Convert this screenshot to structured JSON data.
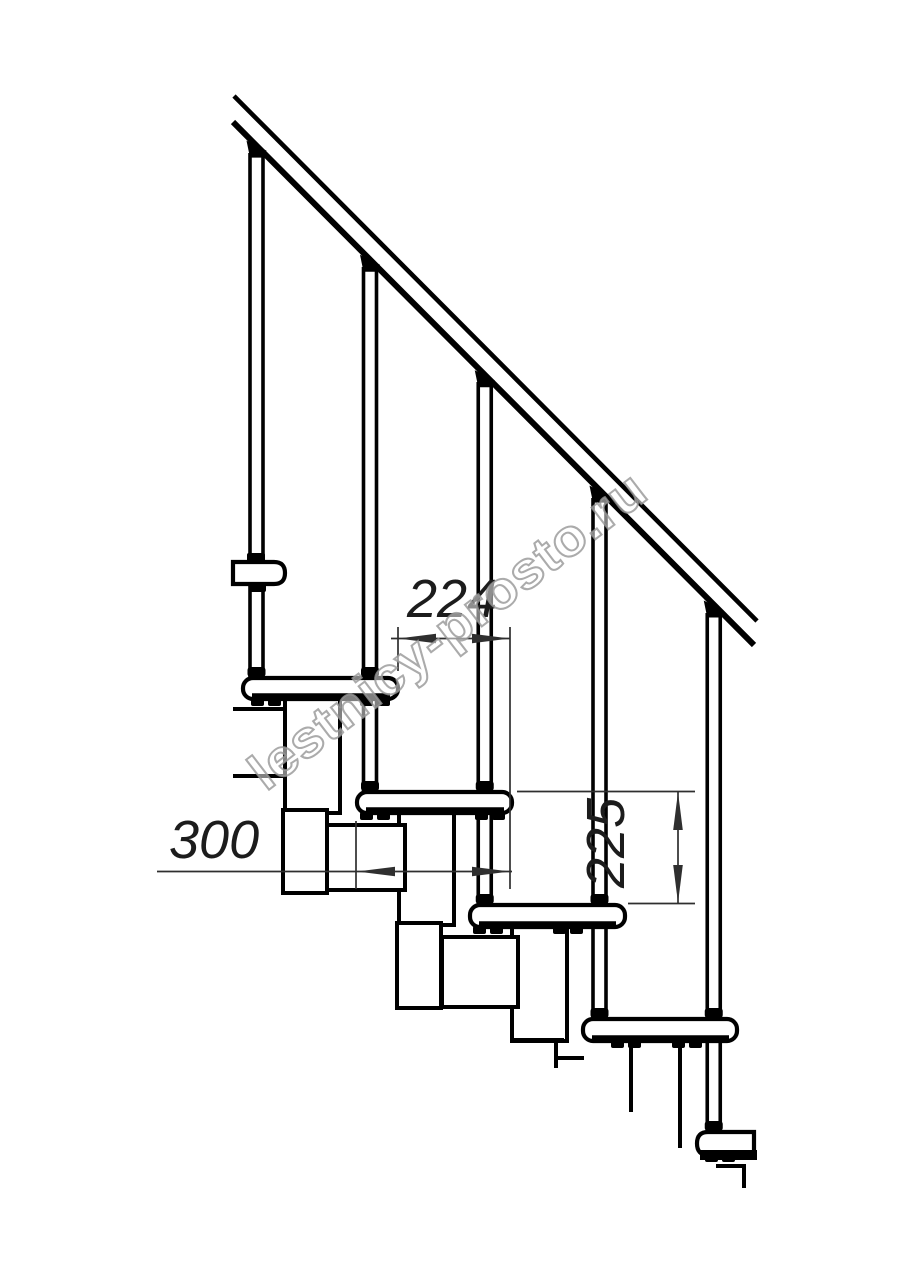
{
  "title": "Modular staircase side elevation drawing",
  "drawing": {
    "dimensions": {
      "step_run": "224",
      "tread_depth": "300",
      "riser_height": "225"
    },
    "watermark": "lestnicy-prosto.ru",
    "colors": {
      "line": "#000000",
      "dimension_line": "#2f2f2f",
      "watermark": "#969696",
      "background": "#ffffff"
    }
  }
}
